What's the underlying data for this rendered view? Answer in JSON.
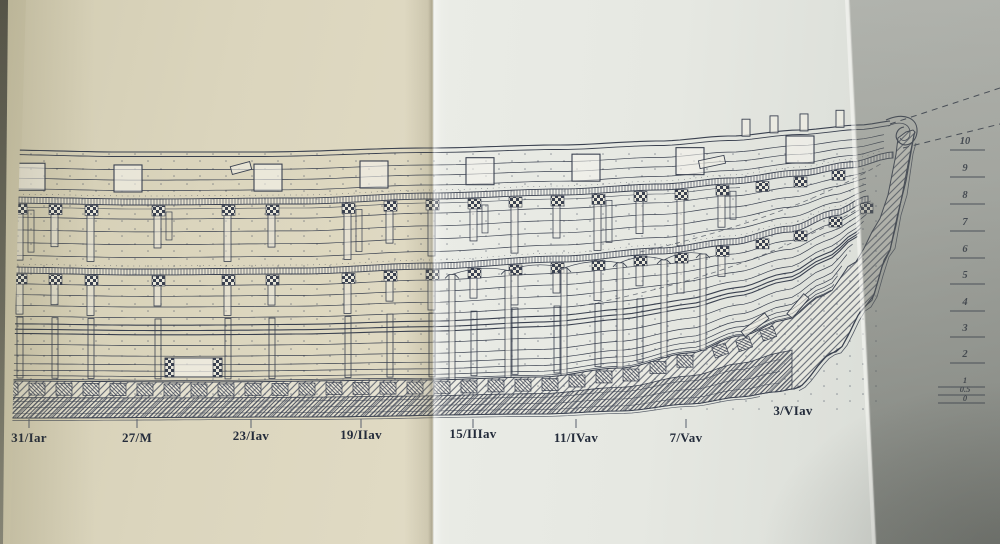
{
  "drawing": {
    "description": "Longitudinal inboard-profile plate of a wooden sailing ship hull, photographed across a book fold",
    "station_labels": [
      {
        "label": "31/Iar"
      },
      {
        "label": "27/M"
      },
      {
        "label": "23/Iav"
      },
      {
        "label": "19/IIav"
      },
      {
        "label": "15/IIIav"
      },
      {
        "label": "11/IVav"
      },
      {
        "label": "7/Vav"
      },
      {
        "label": "3/VIav"
      }
    ],
    "waterline_scale": [
      {
        "label": "10"
      },
      {
        "label": "9"
      },
      {
        "label": "8"
      },
      {
        "label": "7"
      },
      {
        "label": "6"
      },
      {
        "label": "5"
      },
      {
        "label": "4"
      },
      {
        "label": "3"
      },
      {
        "label": "2"
      },
      {
        "label": "1"
      },
      {
        "label": "0.5"
      },
      {
        "label": "0"
      }
    ],
    "colors": {
      "ink": "#3a4150",
      "page_left": "#e0dac4",
      "page_right": "#e6e8e2",
      "page_shadow": "#aaada7"
    }
  }
}
